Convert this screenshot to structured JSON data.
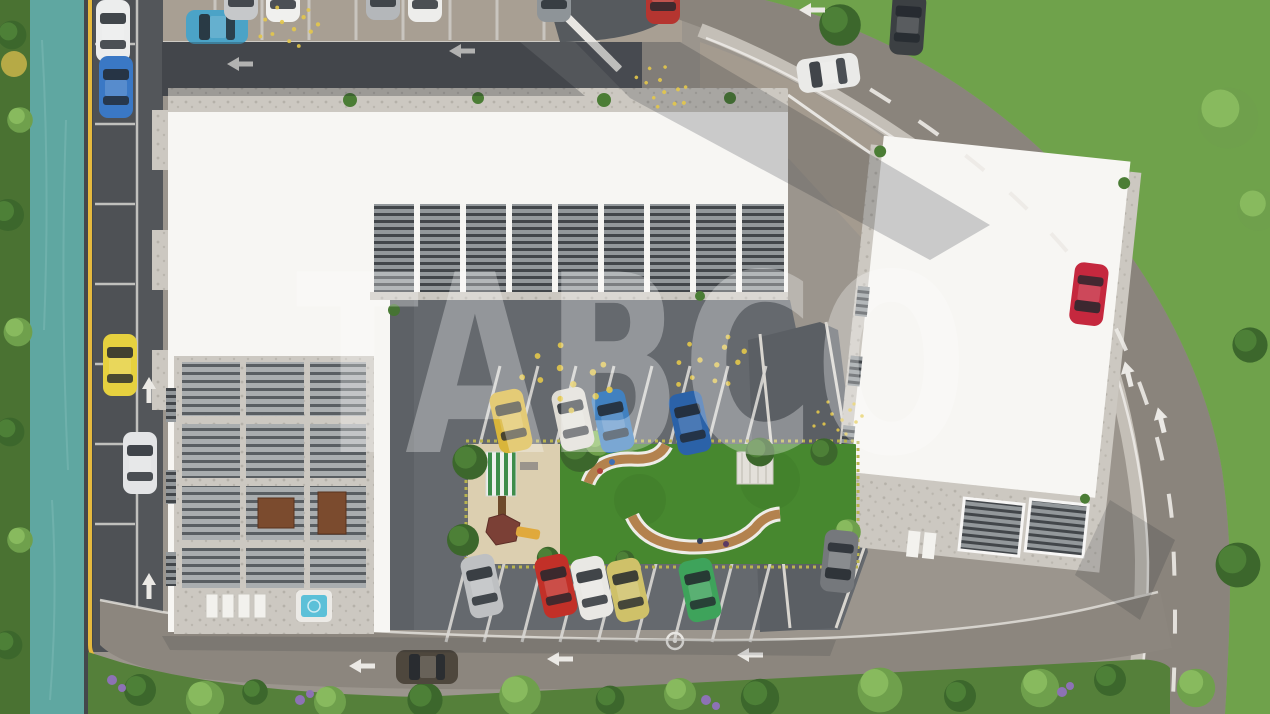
{
  "watermark": {
    "text": "TABCO",
    "color": "#ffffff",
    "opacity": 0.3
  },
  "palette": {
    "water": "#5fa7a1",
    "vegetation": "#4a7232",
    "grass": "#6fa24b",
    "lawn": "#47882f",
    "sand": "#dccfb0",
    "building_white": "#f7f6f3",
    "terrace_gravel": "#ccc8c1",
    "asphalt_court": "#65696e",
    "road_dark": "#53565a",
    "road_main": "#8a847c",
    "road_bottom": "#8c867e",
    "pavement": "#a89f93",
    "curb_yellow": "#e5b93e",
    "marking_white": "#ebe9e5",
    "hot_tub": "#5cc0d8"
  },
  "cars": [
    {
      "name": "left-lane-parked-white",
      "color": "#eceded"
    },
    {
      "name": "left-lane-parked-blue",
      "color": "#3a78c5"
    },
    {
      "name": "left-lane-parked-yellow",
      "color": "#e6d13f"
    },
    {
      "name": "left-lane-driving-white",
      "color": "#e3e4e6"
    },
    {
      "name": "top-parking-teal",
      "color": "#4ba3c7"
    },
    {
      "name": "top-parking-silver",
      "color": "#c6c8ca"
    },
    {
      "name": "top-parking-white",
      "color": "#f0f0ee"
    },
    {
      "name": "top-parking-silver-2",
      "color": "#b4b7ba"
    },
    {
      "name": "top-parking-white-2",
      "color": "#ededeb"
    },
    {
      "name": "top-parking-gray",
      "color": "#8e9498"
    },
    {
      "name": "top-parking-red",
      "color": "#b53530"
    },
    {
      "name": "entrance-parked-white",
      "color": "#eaeae8"
    },
    {
      "name": "street-driving-dark",
      "color": "#3c4043"
    },
    {
      "name": "right-street-red",
      "color": "#c5283e"
    },
    {
      "name": "courtyard-north-yellow",
      "color": "#d9b53a"
    },
    {
      "name": "courtyard-north-white",
      "color": "#dfdcd4"
    },
    {
      "name": "courtyard-north-lightblue",
      "color": "#4181c0"
    },
    {
      "name": "courtyard-north-blue",
      "color": "#2b62a8"
    },
    {
      "name": "courtyard-south-silver",
      "color": "#bec0c2"
    },
    {
      "name": "courtyard-south-red",
      "color": "#c23028"
    },
    {
      "name": "courtyard-south-white",
      "color": "#e9e8e4"
    },
    {
      "name": "courtyard-south-olive",
      "color": "#cfc169"
    },
    {
      "name": "courtyard-south-green",
      "color": "#3ea35b"
    },
    {
      "name": "ramp-driving-gray",
      "color": "#75787c"
    },
    {
      "name": "bottom-street-driving-gray",
      "color": "#4e473d"
    }
  ]
}
